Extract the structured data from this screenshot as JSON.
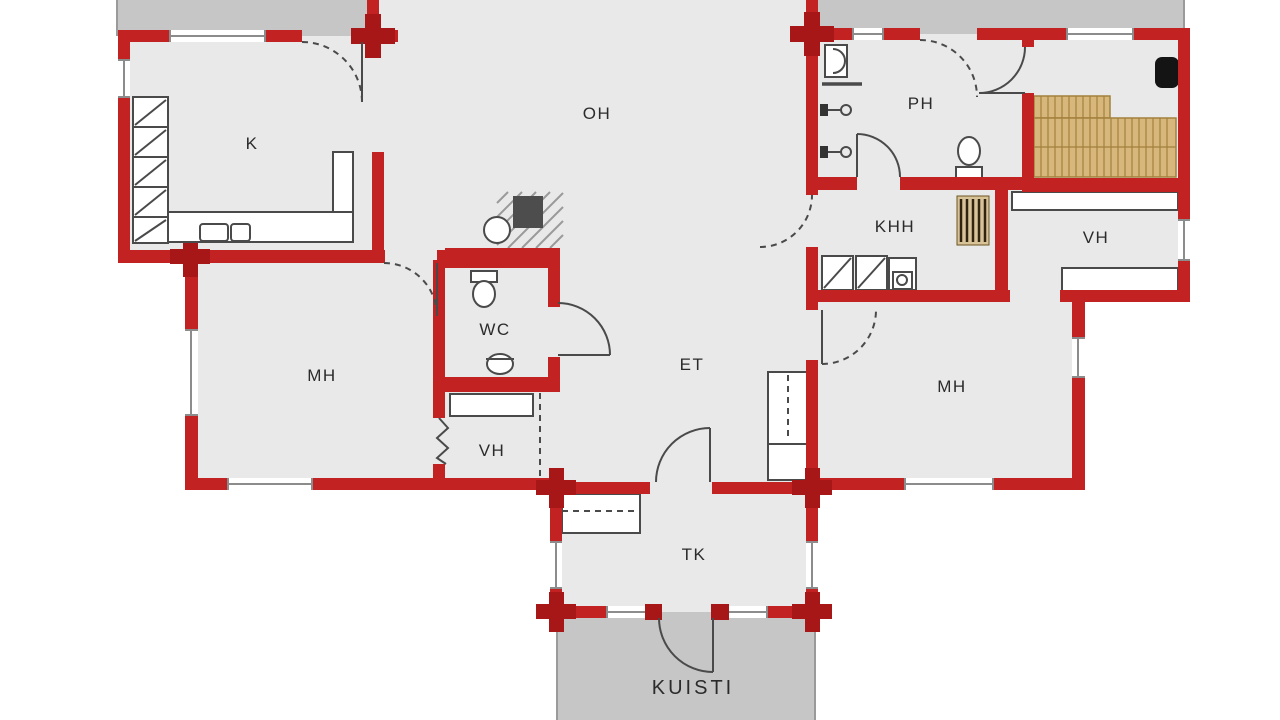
{
  "title": "floor-plan",
  "rooms": [
    {
      "id": "kitchen",
      "label": "K"
    },
    {
      "id": "living-room",
      "label": "OH"
    },
    {
      "id": "washroom",
      "label": "PH"
    },
    {
      "id": "utility-room",
      "label": "KHH"
    },
    {
      "id": "closet-right",
      "label": "VH"
    },
    {
      "id": "bedroom-left",
      "label": "MH"
    },
    {
      "id": "wc",
      "label": "WC"
    },
    {
      "id": "hallway",
      "label": "ET"
    },
    {
      "id": "closet-left",
      "label": "VH"
    },
    {
      "id": "bedroom-right",
      "label": "MH"
    },
    {
      "id": "vestibule",
      "label": "TK"
    },
    {
      "id": "porch",
      "label": "KUISTI"
    }
  ],
  "colors": {
    "wall": "#c32222",
    "wall_junction": "#a81717",
    "floor": "#e9e9e9",
    "terrace": "#c6c6c6",
    "line": "#4a4a4a",
    "window_line": "#8c8c8c",
    "bench": "#d7b77c",
    "bench_line": "#a3803c",
    "stove": "#141414",
    "fireplace_core": "#4d4d4d",
    "label": "#2b2b2b"
  }
}
